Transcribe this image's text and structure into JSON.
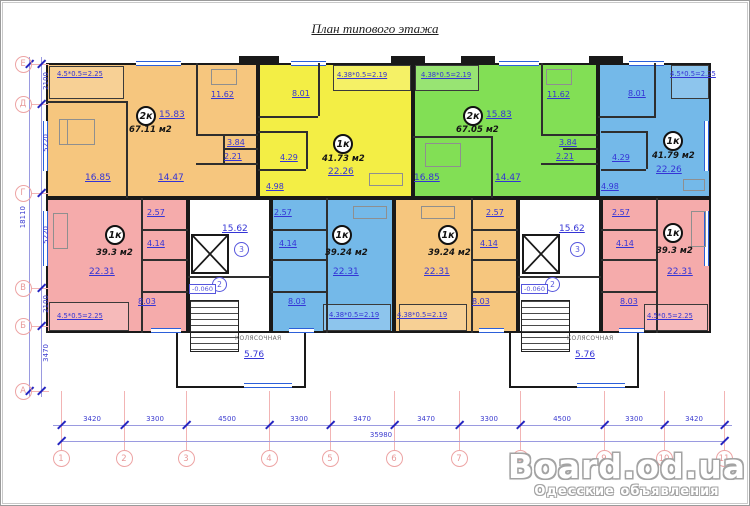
{
  "title": "План типового этажа",
  "watermark": {
    "brand": "Board.od.ua",
    "subtitle": "Одесские объявления"
  },
  "apartments": {
    "top_orange": {
      "type": "2к",
      "living": "15.83",
      "total": "67.11 м2",
      "bedroom": "16.85",
      "hall": "14.47",
      "kitchen": "11.62",
      "bath": "3.84",
      "wc": "2.21",
      "balcony": "4.5*0.5=2.25"
    },
    "top_yellow": {
      "type": "1к",
      "total": "41.73 м2",
      "living": "22.26",
      "kitchen": "8.01",
      "bath": "4.29",
      "hall": "4.98",
      "balcony": "4.38*0.5=2.19"
    },
    "top_green": {
      "type": "2к",
      "living": "15.83",
      "total": "67.05 м2",
      "bedroom": "16.85",
      "hall": "14.47",
      "kitchen": "11.62",
      "bath": "3.84",
      "wc": "2.21",
      "balcony": "4.38*0.5=2.19"
    },
    "top_blue": {
      "type": "1к",
      "total": "41.79 м2",
      "living": "22.26",
      "kitchen": "8.01",
      "bath": "4.29",
      "hall": "4.98",
      "balcony": "4.5*0.5=2.25"
    },
    "bottom_pink_l": {
      "type": "1к",
      "total": "39.3 м2",
      "living": "22.31",
      "kitchen": "8.03",
      "bath": "4.14",
      "hall": "2.57",
      "balcony": "4.5*0.5=2.25"
    },
    "bottom_blue": {
      "type": "1к",
      "total": "39.24 м2",
      "living": "22.31",
      "kitchen": "8.03",
      "bath": "4.14",
      "hall": "2.57",
      "balcony": "4.38*0.5=2.19"
    },
    "bottom_orange": {
      "type": "1к",
      "total": "39.24 м2",
      "living": "22.31",
      "kitchen": "8.03",
      "bath": "4.14",
      "hall": "2.57",
      "balcony": "4.38*0.5=2.19"
    },
    "bottom_pink_r": {
      "type": "1к",
      "total": "39.3 м2",
      "living": "22.31",
      "kitchen": "8.03",
      "bath": "4.14",
      "hall": "2.57",
      "balcony": "4.5*0.5=2.25"
    }
  },
  "cores": {
    "left": {
      "corridor": "15.62",
      "corridor_num": "3",
      "stair_num": "2",
      "level": "-0.060",
      "stroller_label": "КОЛЯСОЧНАЯ",
      "stroller_area": "5.76"
    },
    "right": {
      "corridor": "15.62",
      "corridor_num": "3",
      "stair_num": "2",
      "level": "-0.060",
      "stroller_label": "КОЛЯСОЧНАЯ",
      "stroller_area": "5.76"
    }
  },
  "dimensions": {
    "bottom_segments": [
      "3420",
      "3300",
      "4500",
      "3300",
      "3470",
      "3470",
      "3300",
      "4500",
      "3300",
      "3420"
    ],
    "bottom_total": "35980",
    "left_segments": [
      "2100",
      "5220",
      "5220",
      "2100",
      "3470"
    ],
    "left_total": "18110"
  },
  "grid": {
    "cols": [
      "1",
      "2",
      "3",
      "4",
      "5",
      "6",
      "7",
      "8",
      "9",
      "10",
      "11"
    ],
    "rows": [
      "Е",
      "Д",
      "Г",
      "В",
      "Б",
      "А"
    ]
  },
  "colors": {
    "orange": "#f6c67e",
    "yellow": "#f3ee45",
    "green": "#82df55",
    "blue": "#74b9e9",
    "pink": "#f5abab",
    "dim_text": "#3c3cd0",
    "grid_pink": "#f2b4b4"
  }
}
